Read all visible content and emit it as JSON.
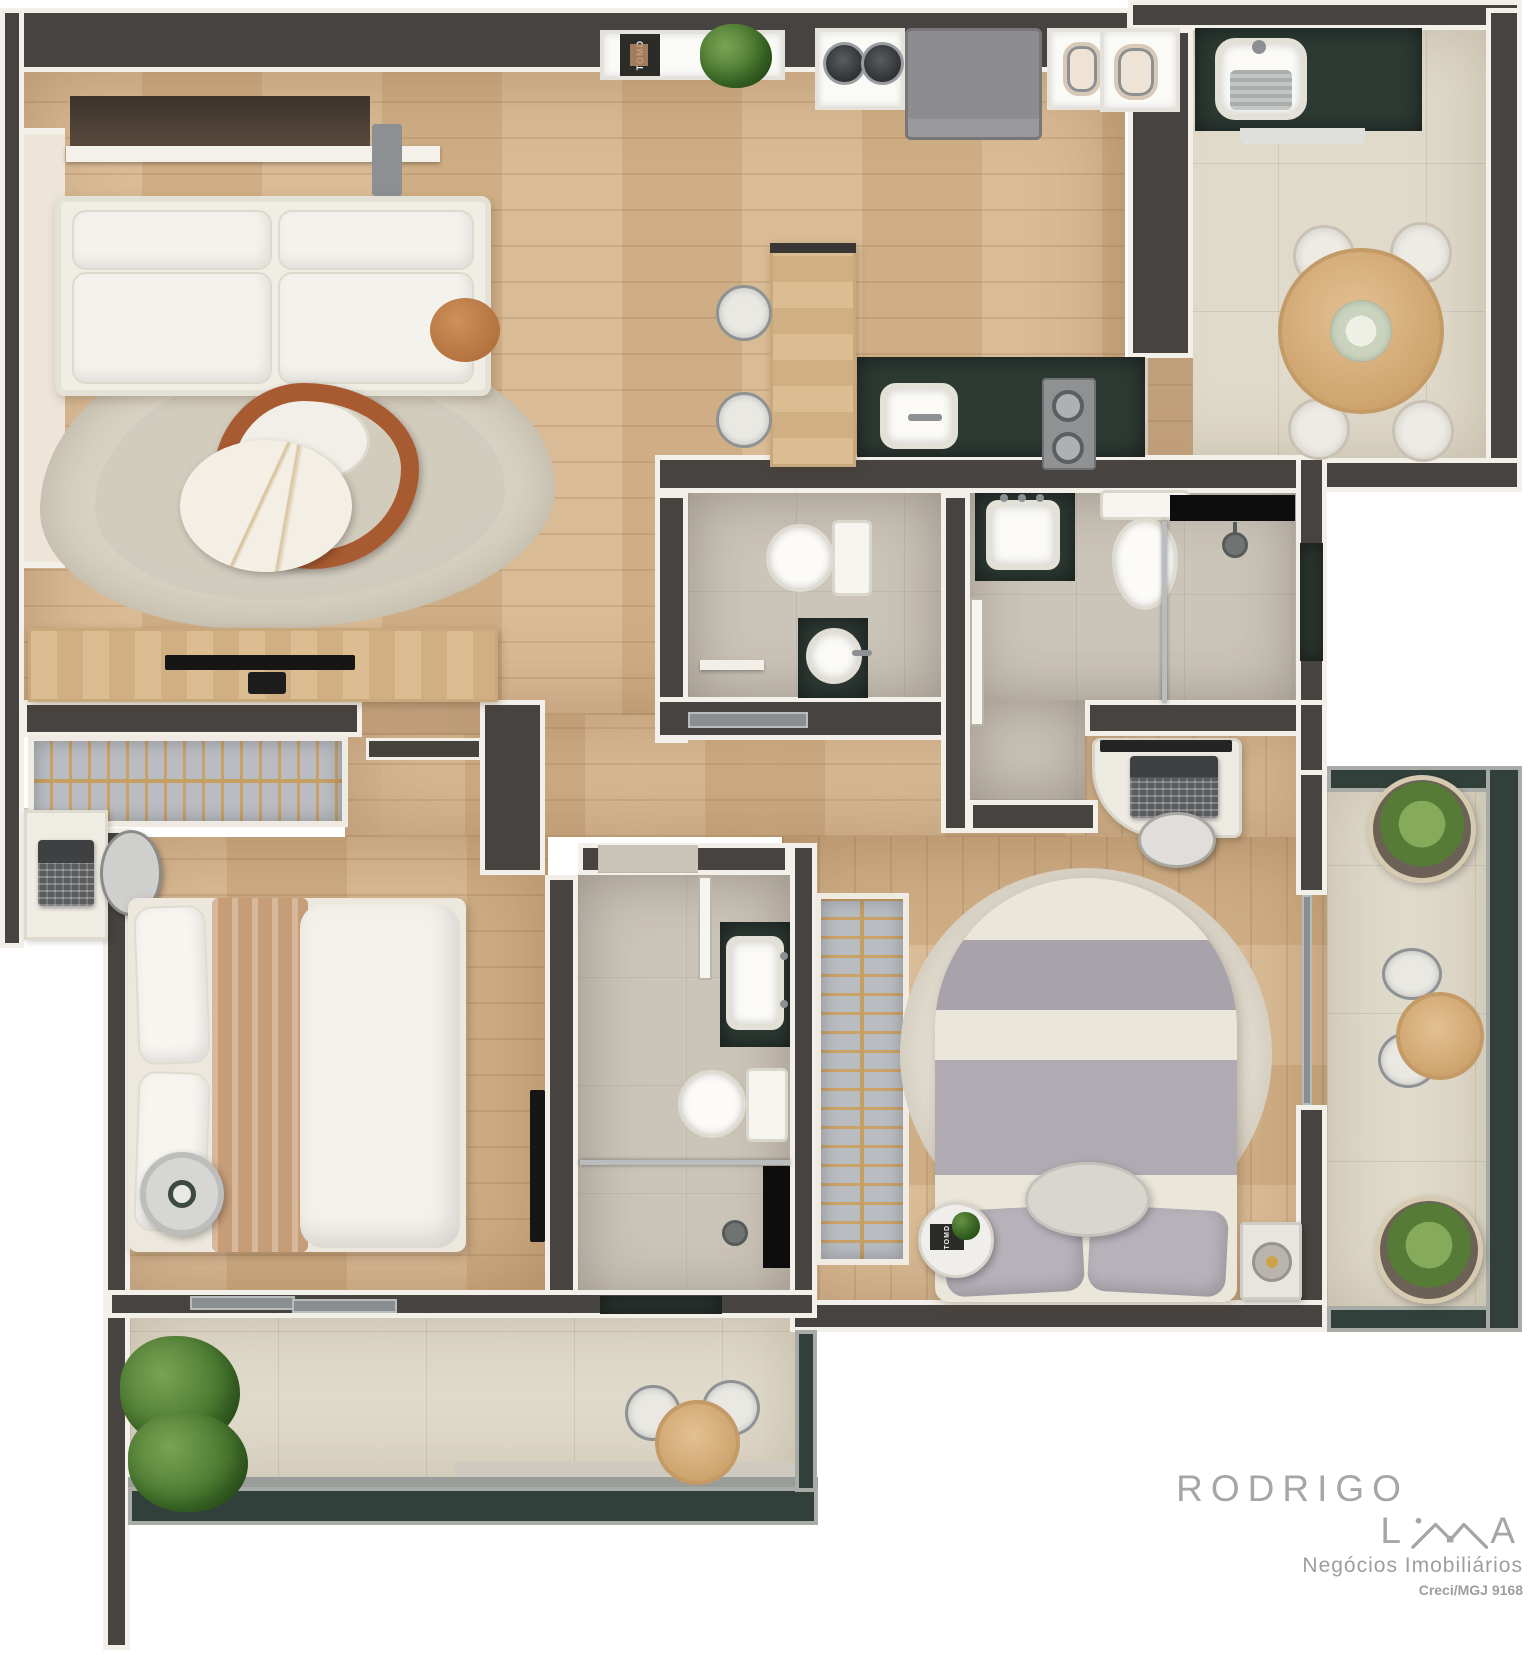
{
  "document": {
    "type": "3d-rendered floor plan, top view, two-bedroom apartment"
  },
  "branding": {
    "wordmark_prefix": "RODRIGO L",
    "wordmark_suffix": "A",
    "roof_icon": "house-roof-icon",
    "subtitle": "Negócios Imobiliários",
    "license": "Creci/MGJ 9168",
    "color": "#a6a6a6"
  },
  "labels": {
    "magazine_cover": "TOMD"
  },
  "palette": {
    "background": "#ffffff",
    "wall": "#474340",
    "wall_trim": "#f3f0e9",
    "wood_floor": "#d6b58c",
    "tile_floor": "#e0dacb",
    "bath_tile": "#cbc4b8",
    "stone_counter_green": "#2d3933",
    "glass_rail_green": "#31403a",
    "furniture_white": "#efece4",
    "accent_wood_ring": "#a85a30",
    "bedding_gray": "#aca6ae",
    "plant_green": "#5d8440"
  },
  "rooms": [
    {
      "id": "living-room",
      "features": [
        "entry-console",
        "sofa",
        "organic-rug",
        "marble-coffee-table",
        "wood-side-table",
        "tv-sideboard",
        "tv"
      ]
    },
    {
      "id": "kitchen",
      "features": [
        "decor-shelf",
        "magazine",
        "plant",
        "appliance-niche",
        "fridge",
        "island-with-stools",
        "green-stone-counter",
        "sink",
        "two-burner-cooktop"
      ]
    },
    {
      "id": "dining-service-terrace",
      "features": [
        "laundry-sink-counter",
        "round-dining-table",
        "four-chairs",
        "flower-centerpiece",
        "small-appliance-niches"
      ]
    },
    {
      "id": "powder-room",
      "features": [
        "toilet",
        "round-vessel-basin",
        "sliding-door"
      ]
    },
    {
      "id": "bathroom-2",
      "features": [
        "basin-on-green-counter",
        "toilet",
        "glass-shower",
        "black-niche",
        "window",
        "door"
      ]
    },
    {
      "id": "bedroom-1",
      "features": [
        "open-closet-with-hangers",
        "desk",
        "laptop",
        "chair",
        "bed",
        "round-side-table",
        "wall-tv",
        "sliding-door-to-terrace"
      ]
    },
    {
      "id": "bathroom-3",
      "features": [
        "basin-on-green-counter",
        "toilet",
        "glass-shower",
        "black-niche",
        "window-to-terrace"
      ]
    },
    {
      "id": "suite-bedroom",
      "features": [
        "open-closet-with-hangers",
        "round-rug",
        "double-bed",
        "pouf",
        "side-table-with-magazine",
        "night-stand-with-lamp",
        "desk",
        "laptop",
        "chair",
        "sliding-door-to-balcony"
      ]
    },
    {
      "id": "side-balcony",
      "features": [
        "planter",
        "planter",
        "bistro-table",
        "two-chairs",
        "glass-railing"
      ]
    },
    {
      "id": "bottom-terrace",
      "features": [
        "plant",
        "bistro-table",
        "two-chairs",
        "glass-railing"
      ]
    }
  ]
}
